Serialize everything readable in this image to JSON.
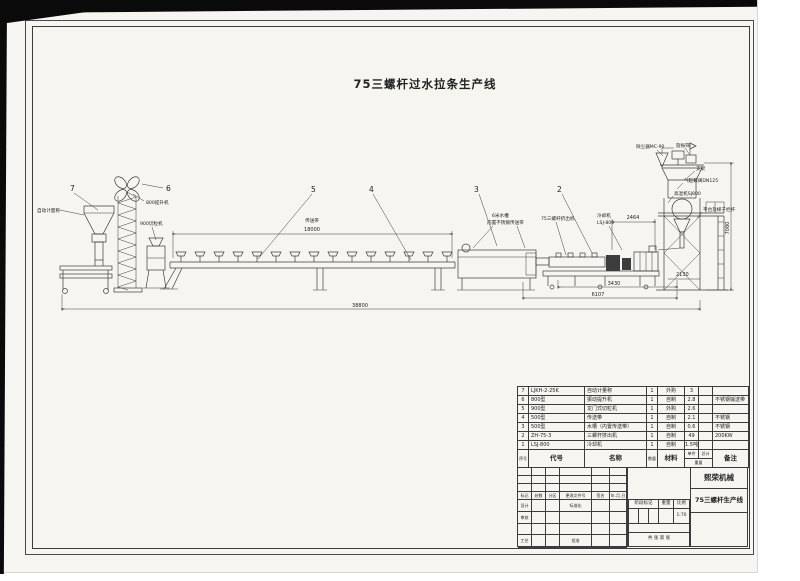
{
  "title": "75三螺杆过水拉条生产线",
  "drawing": {
    "balloons": {
      "b7": "7",
      "b6": "6",
      "b5": "5",
      "b4": "4",
      "b3": "3",
      "b2": "2"
    },
    "labels": {
      "weigher": "自动计量称",
      "elevator": "800提升机",
      "pelletizer": "900切粒机",
      "belt": "传送带",
      "tank1": "6米水槽",
      "tank2": "内置不锈钢传送带",
      "extruder": "75三螺杆挤出机",
      "cooler1": "冷却机",
      "cooler2": "LSJ-800",
      "dust": "除尘器MC-90",
      "screen": "旋振筛",
      "bracket": "支架",
      "valve": "气缸蝶阀DN125",
      "mixer": "高混机SJ800",
      "platform": "平台及梯子栏杆"
    },
    "dims": {
      "belt": "18000",
      "cooler": "2464",
      "tower_h": "7080",
      "step": "2130",
      "extruder": "3430",
      "section": "6107",
      "total": "38800"
    }
  },
  "bom": {
    "headers": {
      "no": "序号",
      "code": "代号",
      "name": "名称",
      "qty": "数量",
      "material": "材料",
      "unit": "单件",
      "total": "总计",
      "weight": "重量",
      "note": "备注"
    },
    "rows": [
      {
        "no": "7",
        "code": "LJKH-2-25K",
        "name": "自动计量称",
        "qty": "1",
        "material": "外购",
        "unit": "3",
        "total": "",
        "note": ""
      },
      {
        "no": "6",
        "code": "800型",
        "name": "振动提升机",
        "qty": "1",
        "material": "自制",
        "unit": "2.8",
        "total": "",
        "note": "不锈钢输送带"
      },
      {
        "no": "5",
        "code": "900型",
        "name": "龙门式切粒机",
        "qty": "1",
        "material": "外购",
        "unit": "2.6",
        "total": "",
        "note": ""
      },
      {
        "no": "4",
        "code": "500型",
        "name": "传送带",
        "qty": "1",
        "material": "自制",
        "unit": "2.1",
        "total": "",
        "note": "不锈钢"
      },
      {
        "no": "3",
        "code": "500型",
        "name": "水槽（内置传送带）",
        "qty": "1",
        "material": "自制",
        "unit": "0.6",
        "total": "",
        "note": "不锈钢"
      },
      {
        "no": "2",
        "code": "ZH-75-3",
        "name": "三螺杆挤出机",
        "qty": "1",
        "material": "自制",
        "unit": "49",
        "total": "",
        "note": "200KW"
      },
      {
        "no": "1",
        "code": "LSJ-800",
        "name": "冷却机",
        "qty": "1",
        "material": "自制",
        "unit": "1.5吨",
        "total": "",
        "note": ""
      }
    ]
  },
  "title_block": {
    "company": "熙荣机械",
    "product": "75三螺杆生产线",
    "rev": [
      "标记",
      "处数",
      "分区",
      "更改文件号",
      "签名",
      "年.月.日"
    ],
    "roles": {
      "design": "设计",
      "check": "审核",
      "process": "工艺",
      "standard": "标准化",
      "approve": "批准"
    },
    "stage": "阶段标记",
    "weight": "重量",
    "scale": "比例",
    "scale_value": "1:70",
    "sheets": "共  张  第  张"
  }
}
